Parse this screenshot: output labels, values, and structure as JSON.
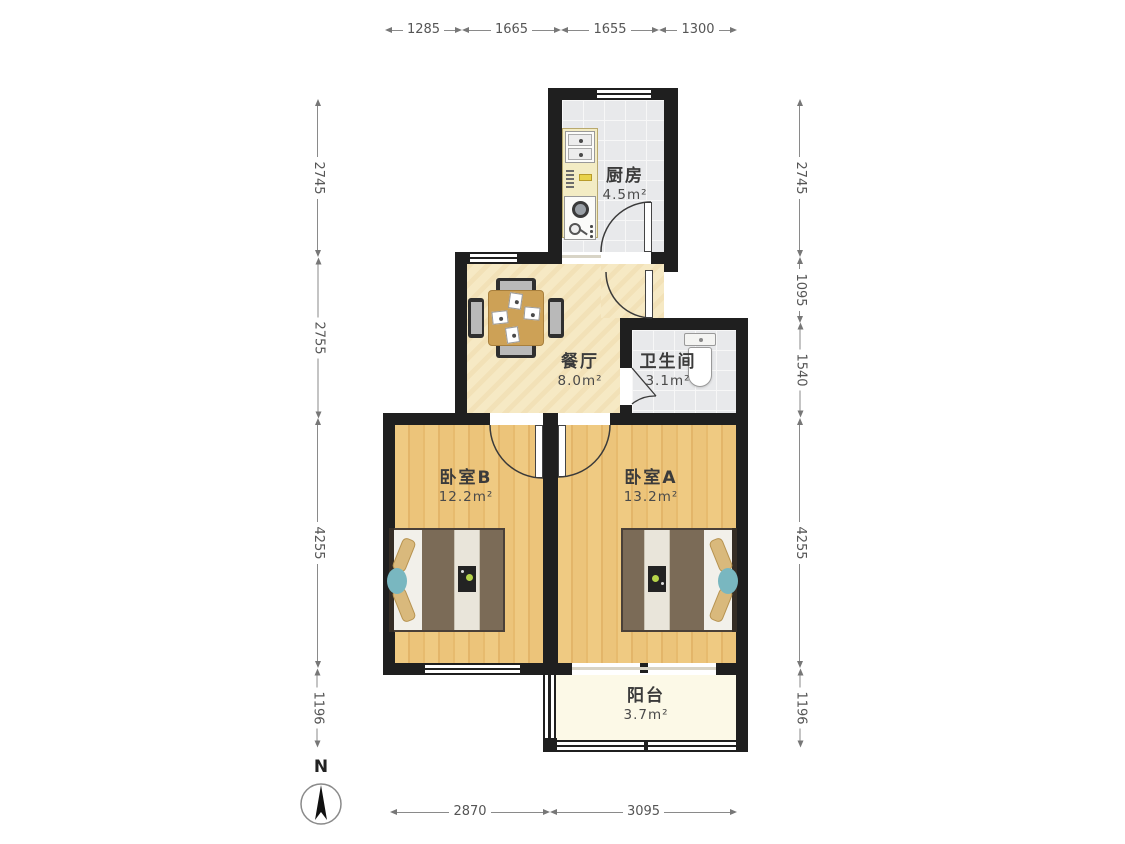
{
  "rooms": {
    "kitchen": {
      "name": "厨房",
      "area": "4.5m²"
    },
    "dining": {
      "name": "餐厅",
      "area": "8.0m²"
    },
    "bathroom": {
      "name": "卫生间",
      "area": "3.1m²"
    },
    "bedroom_b": {
      "name": "卧室B",
      "area": "12.2m²"
    },
    "bedroom_a": {
      "name": "卧室A",
      "area": "13.2m²"
    },
    "balcony": {
      "name": "阳台",
      "area": "3.7m²"
    }
  },
  "dimensions_mm": {
    "top": [
      "1285",
      "1665",
      "1655",
      "1300"
    ],
    "left": [
      "2745",
      "2755",
      "4255",
      "1196"
    ],
    "right": [
      "2745",
      "1095",
      "1540",
      "4255",
      "1196"
    ],
    "bottom": [
      "2870",
      "3095"
    ]
  },
  "compass": {
    "north_label": "N"
  },
  "colors": {
    "wall": "#1f1f1f",
    "wood_floor": "#eec87f",
    "tile_floor": "#e8e9eb",
    "dining_floor": "#f6e9c4",
    "balcony_floor": "#fcf9e7",
    "counter": "#f3ecc4",
    "bed_blanket": "#7b6b57",
    "pillow": "#d9b97c",
    "accent_teal": "#79b7c0",
    "accent_green": "#b6d44a",
    "dimension_text": "#555555"
  }
}
